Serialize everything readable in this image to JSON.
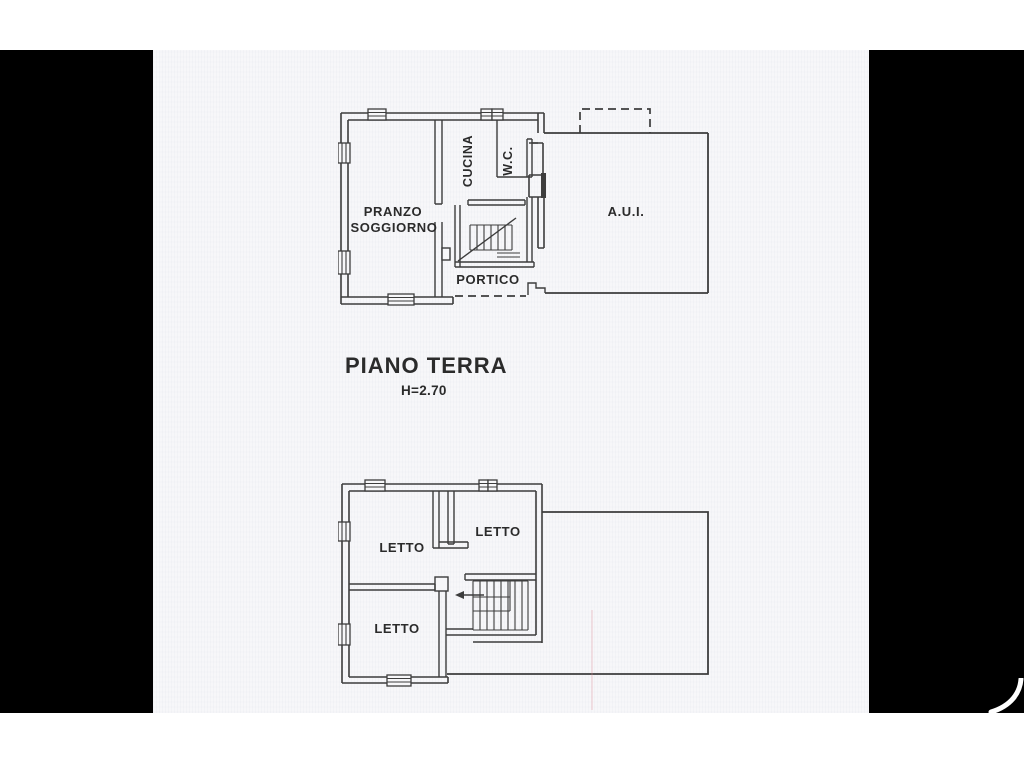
{
  "document": {
    "floor_title": "PIANO TERRA",
    "floor_height_note": "H=2.70",
    "plan_ground": {
      "room_pranzo_line1": "PRANZO",
      "room_pranzo_line2": "SOGGIORNO",
      "room_cucina": "CUCINA",
      "room_wc": "W.C.",
      "room_aui": "A.U.I.",
      "room_portico": "PORTICO"
    },
    "plan_first": {
      "room_letto_top_left": "LETTO",
      "room_letto_top_right": "LETTO",
      "room_letto_bottom": "LETTO"
    }
  },
  "colors": {
    "background": "#000000",
    "paper": "#f7f7f9",
    "line": "#3d3d3d",
    "text": "#2b2b2b"
  }
}
